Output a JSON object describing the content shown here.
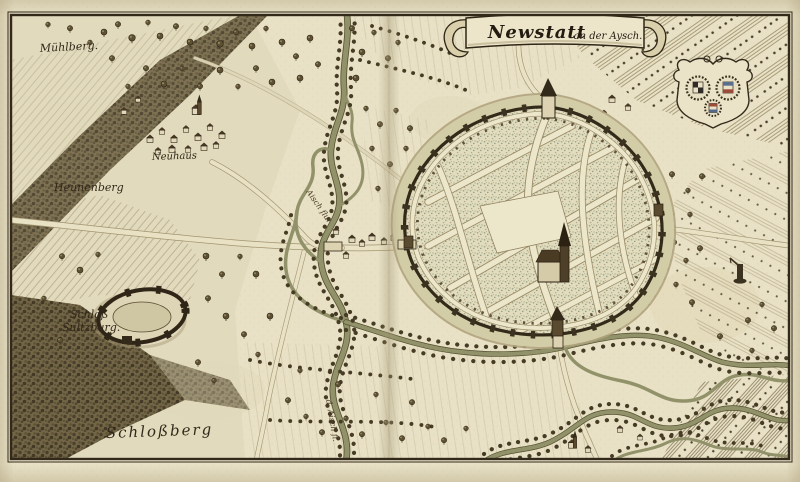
{
  "map": {
    "title": {
      "main": "Newstatt",
      "sub": "an der Aysch."
    },
    "labels": {
      "muehlberg": "Mühlberg.",
      "neuhaus": "Neuhaus",
      "heunenberg": "Heunenberg",
      "schloss_line1": "Schloß",
      "schloss_line2": "Sultzburg.",
      "schlossberg": "Schloßberg",
      "river_upper": "Aisch flu.",
      "river_lower": "d. Aisch fl."
    },
    "icons": {
      "banner": "ribbon-banner",
      "coat_of_arms": "coat-of-arms-crest",
      "town": "walled-town",
      "church": "church-with-spire",
      "castle": "ring-castle-ruin",
      "monument": "wayside-column",
      "tree": "round-tree",
      "house": "gabled-house"
    },
    "colors": {
      "paper": "#e8e1c6",
      "ink": "#33291a",
      "river": "#91926a",
      "moat": "#d3cda7",
      "stipple": "#9aa37f",
      "forest": "#4c4028",
      "shading": "#a1946f"
    }
  }
}
